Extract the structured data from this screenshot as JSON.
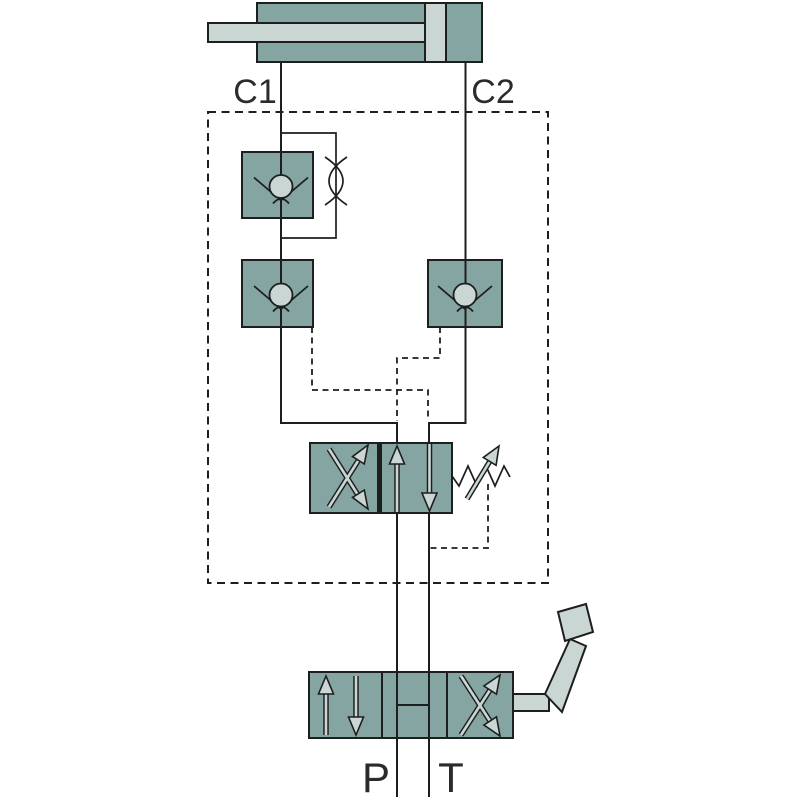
{
  "diagram": {
    "kind": "hydraulic-circuit-schematic",
    "labels": {
      "c1": "C1",
      "c2": "C2",
      "p": "P",
      "t": "T"
    },
    "icons": [
      "hydraulic-cylinder-icon",
      "flow-restrictor-check-valve-icon",
      "pilot-operated-check-valve-icon",
      "pilot-directional-valve-icon",
      "adjustable-spring-icon",
      "manual-lever-valve-icon",
      "lever-handle-icon",
      "manifold-boundary-dashed-box"
    ]
  },
  "colors": {
    "bg": "#ffffff",
    "teal": "#85a5a3",
    "light": "#c9d6d4",
    "line": "#1d1f1e",
    "label": "#2b2b2b"
  }
}
